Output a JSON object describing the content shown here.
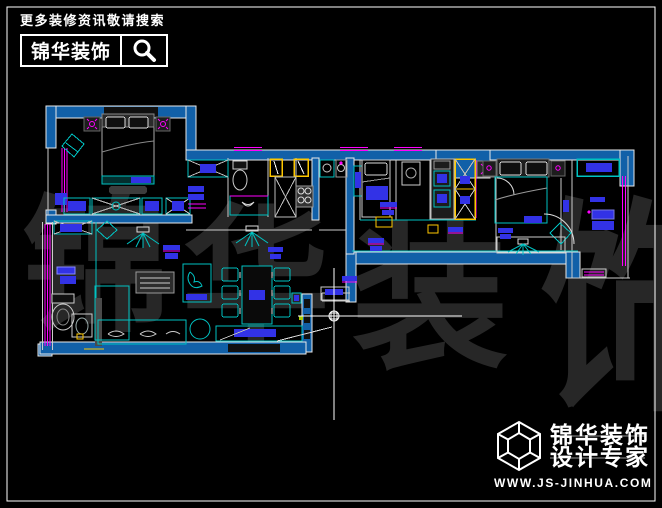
{
  "meta": {
    "width": 662,
    "height": 508,
    "background": "#000000",
    "frame_color": "#ffffff"
  },
  "header": {
    "tagline": "更多装修资讯敬请搜索",
    "brand": "锦华装饰",
    "search_icon": "magnifier-icon"
  },
  "watermark": {
    "color": "#272727",
    "chars": [
      "锦",
      "华",
      "装",
      "饰"
    ]
  },
  "logo": {
    "icon": "wireframe-cube-icon",
    "line1": "锦华装饰",
    "line2": "设计专家",
    "website": "WWW.JS-JINHUA.COM"
  },
  "floorplan": {
    "type": "apartment-cad-plan",
    "colors": {
      "wall": "#1160a8",
      "furniture_outline": "#00c2c2",
      "window": "#ff00ff",
      "furniture_fill": "#3232e6",
      "door_frame": "#ffc800",
      "structure_line": "#ffffff",
      "bed_line": "#aaaaaa"
    },
    "cursor": {
      "type": "cad-crosshair",
      "x": 334,
      "y": 316
    },
    "features": [
      "double-bed",
      "wardrobe-row",
      "nightstands-with-lamps",
      "armchair",
      "l-shaped-sofa",
      "coffee-table",
      "side-table",
      "tv-cabinet",
      "sideboard-with-plant",
      "dining-table-six-chairs",
      "toilet",
      "washbasin",
      "shower-shaft",
      "gas-stove",
      "kitchen-sinks",
      "washing-machine",
      "single-bed",
      "second-double-bed",
      "desk-with-lamp",
      "desk-chair",
      "balcony-cabinet",
      "windows",
      "door-swings",
      "room-labels"
    ]
  }
}
